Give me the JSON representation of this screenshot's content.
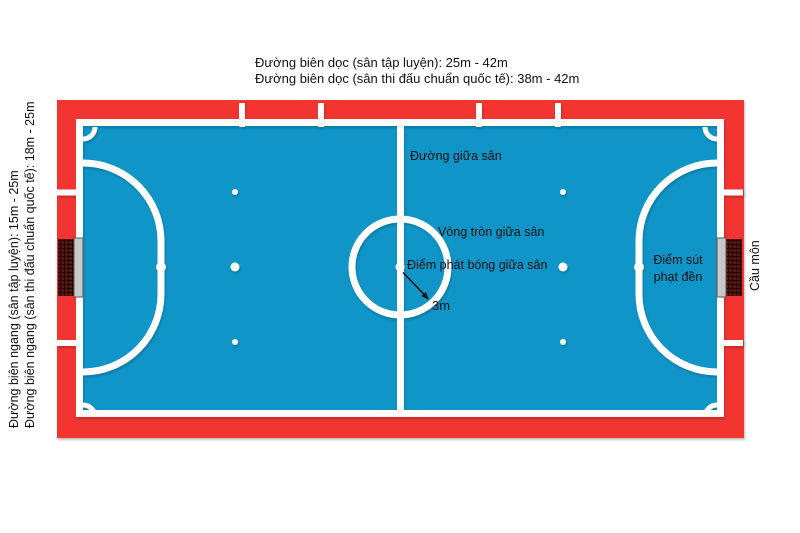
{
  "title": "Futsal court dimensions diagram",
  "labels": {
    "top_length_line1": "Đường biên dọc (sân tập luyện): 25m - 42m",
    "top_length_line2": "Đường biên dọc (sân thi đấu chuẩn quốc tế): 38m - 42m",
    "left_width_line1": "Đường biên ngang (sân tập luyện): 15m - 25m",
    "left_width_line2": "Đường biên ngang (sân thi đấu chuẩn quốc tế): 18m - 25m",
    "halfway_line": "Đường giữa sân",
    "center_circle": "Vòng tròn giữa sân",
    "kickoff_spot": "Điểm phát bóng giữa sân",
    "circle_radius": "3m",
    "penalty_spot_line1": "Điểm sút",
    "penalty_spot_line2": "phạt đền",
    "goal": "Cầu môn"
  },
  "colors": {
    "border_red": "#f23530",
    "field_blue": "#1095c8",
    "line_white": "#ffffff",
    "goal_net": "#5a1511",
    "goal_frame": "#c9c9c9",
    "text": "#111111"
  }
}
